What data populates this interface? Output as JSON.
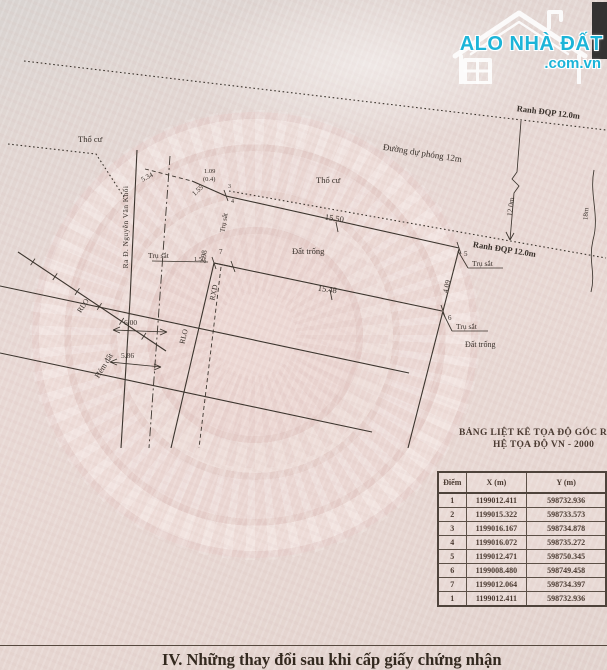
{
  "logo": {
    "brand": "ALO NHÀ ĐẤT",
    "domain": ".com.vn",
    "accent_color": "#1cb4d8"
  },
  "drawing": {
    "area_labels": {
      "tho_cu": "Thổ cư",
      "dat_trong": "Đất trống",
      "duong_du_phong": "Đường dự phóng 12m",
      "ranh_dqp": "Ranh ĐQP 12.0m",
      "hem_dat": "Hẻm đất",
      "street": "Ra Đ. Nguyễn Văn Khối",
      "tru_sat": "Trụ sắt",
      "rlo": "RLO",
      "rxd": "RXD"
    },
    "dimensions": {
      "top_edge": "15.50",
      "bottom_edge": "15.48",
      "right_edge": "4.09",
      "left_edge": "2.98",
      "seg_534": "5.34",
      "seg_109": "1.09",
      "seg_04": "(0.4)",
      "seg_155": "1.55",
      "seg_150": "1.50",
      "width_600": "6.00",
      "width_586": "5.86",
      "road_width": "12.0m",
      "lane_width": "18m"
    },
    "point_labels": {
      "p3": "3",
      "p4": "4",
      "p5": "5",
      "p6": "6",
      "p7": "7"
    }
  },
  "table": {
    "title_line1": "BẢNG LIỆT KÊ TỌA ĐỘ GÓC RANH",
    "title_line2": "HỆ TỌA ĐỘ VN - 2000",
    "headers": [
      "Điểm",
      "X (m)",
      "Y (m)"
    ],
    "rows": [
      [
        "1",
        "1199012.411",
        "598732.936"
      ],
      [
        "2",
        "1199015.322",
        "598733.573"
      ],
      [
        "3",
        "1199016.167",
        "598734.878"
      ],
      [
        "4",
        "1199016.072",
        "598735.272"
      ],
      [
        "5",
        "1199012.471",
        "598750.345"
      ],
      [
        "6",
        "1199008.480",
        "598749.458"
      ],
      [
        "7",
        "1199012.064",
        "598734.397"
      ],
      [
        "1",
        "1199012.411",
        "598732.936"
      ]
    ]
  },
  "footer": {
    "heading": "IV. Những thay đổi sau khi cấp giấy chứng nhận"
  }
}
